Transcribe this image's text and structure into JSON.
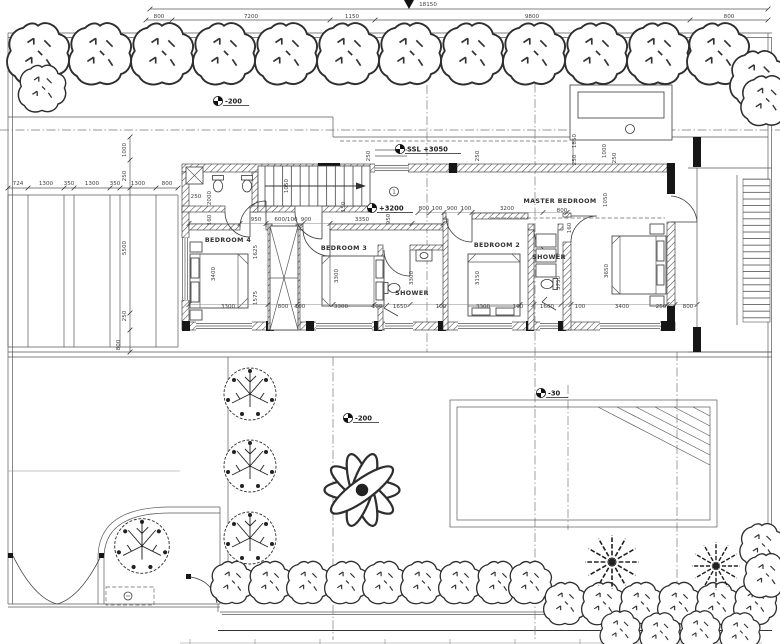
{
  "drawing": {
    "type": "architectural floor plan",
    "colors": {
      "paper": "#ffffff",
      "line": "#3a3a3a",
      "wall": "#161616",
      "dim_text": "#3f3f3f",
      "vegetation": "#2e2e2e"
    }
  },
  "annotations": {
    "rooms": [
      {
        "t": "BEDROOM 4",
        "x": 228,
        "y": 242
      },
      {
        "t": "BEDROOM 3",
        "x": 344,
        "y": 250
      },
      {
        "t": "SHOWER",
        "x": 412,
        "y": 295
      },
      {
        "t": "BEDROOM 2",
        "x": 497,
        "y": 247
      },
      {
        "t": "SHOWER",
        "x": 549,
        "y": 259
      },
      {
        "t": "MASTER BEDROOM",
        "x": 560,
        "y": 203
      }
    ],
    "levels": [
      {
        "t": "-200",
        "x": 218,
        "y": 101,
        "w": 26
      },
      {
        "t": "SSL +3050",
        "x": 400,
        "y": 149,
        "w": 56
      },
      {
        "t": "+3200",
        "x": 372,
        "y": 208,
        "w": 36
      },
      {
        "t": "-200",
        "x": 348,
        "y": 418,
        "w": 26
      },
      {
        "t": "-30",
        "x": 541,
        "y": 393,
        "w": 22
      }
    ],
    "dims": [
      {
        "t": "18150",
        "x": 428,
        "y": 6
      },
      {
        "t": "800",
        "x": 159,
        "y": 18
      },
      {
        "t": "7200",
        "x": 251,
        "y": 18
      },
      {
        "t": "1150",
        "x": 352,
        "y": 18
      },
      {
        "t": "9800",
        "x": 532,
        "y": 18
      },
      {
        "t": "800",
        "x": 729,
        "y": 18
      },
      {
        "t": "724",
        "x": 18,
        "y": 185
      },
      {
        "t": "1300",
        "x": 46,
        "y": 185
      },
      {
        "t": "350",
        "x": 69,
        "y": 185
      },
      {
        "t": "1300",
        "x": 92,
        "y": 185
      },
      {
        "t": "350",
        "x": 115,
        "y": 185
      },
      {
        "t": "1300",
        "x": 138,
        "y": 185
      },
      {
        "t": "800",
        "x": 167,
        "y": 185
      },
      {
        "t": "1000",
        "x": 126,
        "y": 150,
        "r": -90
      },
      {
        "t": "250",
        "x": 126,
        "y": 176,
        "r": -90
      },
      {
        "t": "5500",
        "x": 126,
        "y": 248,
        "r": -90
      },
      {
        "t": "250",
        "x": 126,
        "y": 316,
        "r": -90
      },
      {
        "t": "800",
        "x": 120,
        "y": 345,
        "r": -90
      },
      {
        "t": "250",
        "x": 196,
        "y": 198
      },
      {
        "t": "2000",
        "x": 211,
        "y": 198,
        "r": -90
      },
      {
        "t": "160",
        "x": 211,
        "y": 220,
        "r": -90
      },
      {
        "t": "1050",
        "x": 288,
        "y": 186,
        "r": -90
      },
      {
        "t": "950",
        "x": 256,
        "y": 221
      },
      {
        "t": "600/100",
        "x": 286,
        "y": 221
      },
      {
        "t": "900",
        "x": 306,
        "y": 221
      },
      {
        "t": "3350",
        "x": 362,
        "y": 221
      },
      {
        "t": "150",
        "x": 345,
        "y": 207,
        "r": -90
      },
      {
        "t": "950",
        "x": 390,
        "y": 219,
        "r": -90
      },
      {
        "t": "250",
        "x": 370,
        "y": 156,
        "r": -90
      },
      {
        "t": "250",
        "x": 479,
        "y": 156,
        "r": -90
      },
      {
        "t": "1850",
        "x": 576,
        "y": 141,
        "r": -90
      },
      {
        "t": "250",
        "x": 576,
        "y": 160,
        "r": -90
      },
      {
        "t": "1000",
        "x": 606,
        "y": 151,
        "r": -90
      },
      {
        "t": "250",
        "x": 616,
        "y": 158,
        "r": -90
      },
      {
        "t": "800",
        "x": 424,
        "y": 210
      },
      {
        "t": "100",
        "x": 437,
        "y": 210
      },
      {
        "t": "900",
        "x": 452,
        "y": 210
      },
      {
        "t": "100",
        "x": 466,
        "y": 210
      },
      {
        "t": "3200",
        "x": 507,
        "y": 210
      },
      {
        "t": "800",
        "x": 562,
        "y": 212
      },
      {
        "t": "160",
        "x": 571,
        "y": 228,
        "r": -90
      },
      {
        "t": "1050",
        "x": 607,
        "y": 200,
        "r": -90
      },
      {
        "t": "3400",
        "x": 215,
        "y": 274,
        "r": -90
      },
      {
        "t": "1625",
        "x": 257,
        "y": 252,
        "r": -90
      },
      {
        "t": "1575",
        "x": 257,
        "y": 298,
        "r": -90
      },
      {
        "t": "3300",
        "x": 338,
        "y": 276,
        "r": -90
      },
      {
        "t": "3300",
        "x": 413,
        "y": 278,
        "r": -90
      },
      {
        "t": "3150",
        "x": 479,
        "y": 278,
        "r": -90
      },
      {
        "t": "3750",
        "x": 560,
        "y": 283,
        "r": -90
      },
      {
        "t": "3650",
        "x": 608,
        "y": 271,
        "r": -90
      },
      {
        "t": "3300",
        "x": 228,
        "y": 308
      },
      {
        "t": "800",
        "x": 283,
        "y": 308
      },
      {
        "t": "100",
        "x": 300,
        "y": 308
      },
      {
        "t": "3300",
        "x": 341,
        "y": 308
      },
      {
        "t": "100",
        "x": 377,
        "y": 308
      },
      {
        "t": "1650",
        "x": 400,
        "y": 308
      },
      {
        "t": "100",
        "x": 441,
        "y": 308
      },
      {
        "t": "3300",
        "x": 483,
        "y": 308
      },
      {
        "t": "100",
        "x": 518,
        "y": 308
      },
      {
        "t": "1600",
        "x": 547,
        "y": 308
      },
      {
        "t": "100",
        "x": 580,
        "y": 308
      },
      {
        "t": "3400",
        "x": 622,
        "y": 308
      },
      {
        "t": "250",
        "x": 661,
        "y": 308
      },
      {
        "t": "800",
        "x": 688,
        "y": 308
      },
      {
        "t": "1",
        "x": 394,
        "y": 193.5
      }
    ]
  },
  "plants": {
    "shrubs": [
      {
        "x": 38,
        "y": 53,
        "s": 2.1
      },
      {
        "x": 100,
        "y": 53,
        "s": 2.1
      },
      {
        "x": 162,
        "y": 53,
        "s": 2.1
      },
      {
        "x": 224,
        "y": 53,
        "s": 2.1
      },
      {
        "x": 286,
        "y": 53,
        "s": 2.1
      },
      {
        "x": 348,
        "y": 53,
        "s": 2.1
      },
      {
        "x": 410,
        "y": 53,
        "s": 2.1
      },
      {
        "x": 472,
        "y": 53,
        "s": 2.1
      },
      {
        "x": 534,
        "y": 53,
        "s": 2.1
      },
      {
        "x": 596,
        "y": 53,
        "s": 2.1
      },
      {
        "x": 658,
        "y": 53,
        "s": 2.1
      },
      {
        "x": 718,
        "y": 53,
        "s": 2.1
      },
      {
        "x": 42,
        "y": 88,
        "s": 1.6
      },
      {
        "x": 758,
        "y": 78,
        "s": 1.9
      },
      {
        "x": 766,
        "y": 100,
        "s": 1.7
      },
      {
        "x": 232,
        "y": 582,
        "s": 1.45
      },
      {
        "x": 270,
        "y": 582,
        "s": 1.45
      },
      {
        "x": 308,
        "y": 582,
        "s": 1.45
      },
      {
        "x": 346,
        "y": 582,
        "s": 1.45
      },
      {
        "x": 384,
        "y": 582,
        "s": 1.45
      },
      {
        "x": 422,
        "y": 582,
        "s": 1.45
      },
      {
        "x": 460,
        "y": 582,
        "s": 1.45
      },
      {
        "x": 498,
        "y": 582,
        "s": 1.45
      },
      {
        "x": 530,
        "y": 582,
        "s": 1.45
      },
      {
        "x": 565,
        "y": 603,
        "s": 1.45
      },
      {
        "x": 603,
        "y": 603,
        "s": 1.45
      },
      {
        "x": 641,
        "y": 603,
        "s": 1.45
      },
      {
        "x": 679,
        "y": 603,
        "s": 1.45
      },
      {
        "x": 717,
        "y": 603,
        "s": 1.45
      },
      {
        "x": 755,
        "y": 603,
        "s": 1.45
      },
      {
        "x": 762,
        "y": 545,
        "s": 1.5
      },
      {
        "x": 766,
        "y": 575,
        "s": 1.5
      },
      {
        "x": 620,
        "y": 630,
        "s": 1.35
      },
      {
        "x": 660,
        "y": 632,
        "s": 1.35
      },
      {
        "x": 700,
        "y": 630,
        "s": 1.35
      },
      {
        "x": 740,
        "y": 632,
        "s": 1.35
      }
    ],
    "trees": [
      {
        "x": 250,
        "y": 394,
        "s": 1
      },
      {
        "x": 250,
        "y": 466,
        "s": 1
      },
      {
        "x": 250,
        "y": 538,
        "s": 1
      },
      {
        "x": 142,
        "y": 546,
        "s": 1.05
      }
    ],
    "palms": [
      {
        "x": 362,
        "y": 490,
        "s": 2.5
      }
    ],
    "ferns": [
      {
        "x": 612,
        "y": 562,
        "s": 1.8
      },
      {
        "x": 716,
        "y": 566,
        "s": 1.6
      }
    ]
  }
}
